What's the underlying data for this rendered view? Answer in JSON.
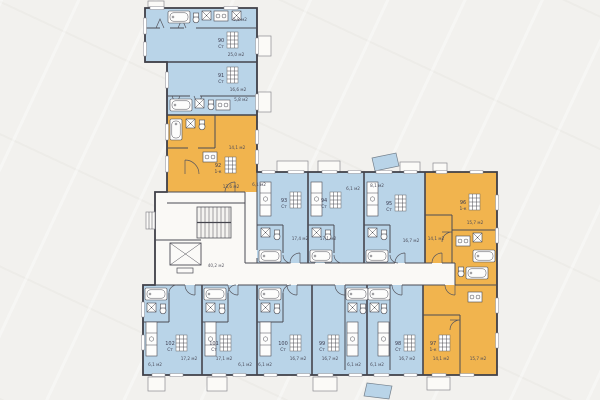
{
  "plan_title": "floor-plan-apartments-90-102",
  "colors": {
    "studio_fill": "#b9d4e8",
    "one_room_fill": "#f1b44e",
    "wall": "#3f3f47",
    "background": "#f2f1ee",
    "balcony_fill": "#fbfaf7"
  },
  "core": {
    "corridor_area": "40,2 м2"
  },
  "apartments": {
    "a90": {
      "number": "90",
      "type": "Ст",
      "area_main": "25,0 м2",
      "area_second": "5,8 м2"
    },
    "a91": {
      "number": "91",
      "type": "Ст",
      "area_main": "16,6 м2",
      "area_second": "5,8 м2"
    },
    "a92": {
      "number": "92",
      "type": "1-к",
      "area_main": "14,1 м2",
      "area_second": "13,6 м2"
    },
    "a93": {
      "number": "93",
      "type": "Ст",
      "area_main": "17,4 м2",
      "area_second": "6,1 м2"
    },
    "a94": {
      "number": "94",
      "type": "Ст",
      "area_main": "17,1 м2",
      "area_second": "6,1 м2"
    },
    "a95": {
      "number": "95",
      "type": "Ст",
      "area_main": "16,7 м2",
      "area_second": "8,1 м2"
    },
    "a96": {
      "number": "96",
      "type": "1-к",
      "area_main": "15,7 м2",
      "area_second": "14,1 м2"
    },
    "a97": {
      "number": "97",
      "type": "1-к",
      "area_main": "14,1 м2",
      "area_second": "15,7 м2"
    },
    "a98": {
      "number": "98",
      "type": "Ст",
      "area_main": "16,7 м2",
      "area_second": "6,1 м2"
    },
    "a99": {
      "number": "99",
      "type": "Ст",
      "area_main": "16,7 м2",
      "area_second": "6,1 м2"
    },
    "a100": {
      "number": "100",
      "type": "Ст",
      "area_main": "16,7 м2",
      "area_second": "6,1 м2"
    },
    "a101": {
      "number": "101",
      "type": "Ст",
      "area_main": "17,1 м2",
      "area_second": "6,1 м2"
    },
    "a102": {
      "number": "102",
      "type": "Ст",
      "area_main": "17,2 м2",
      "area_second": "6,1 м2"
    }
  }
}
